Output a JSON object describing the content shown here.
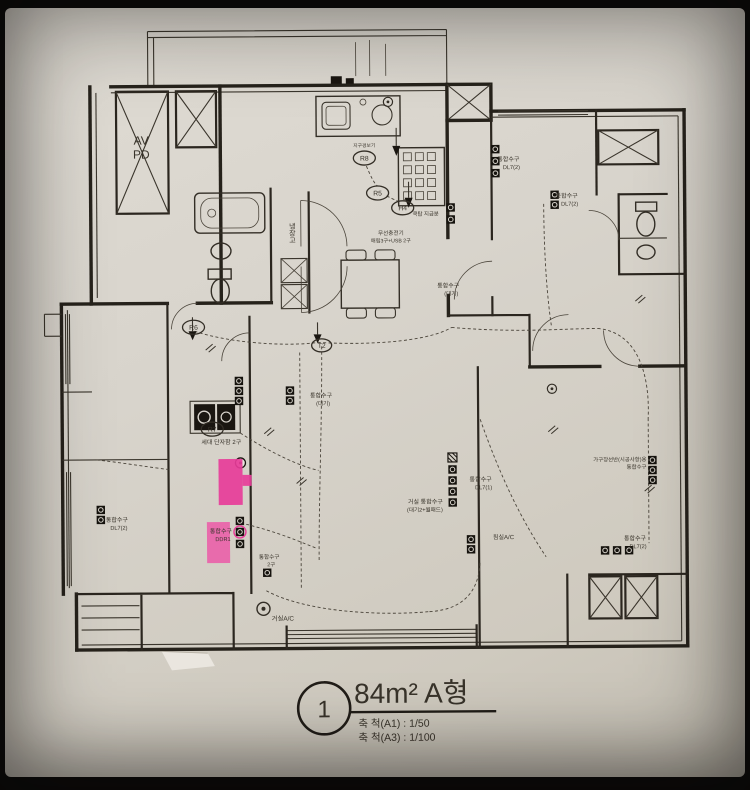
{
  "colors": {
    "paper": "#d8d4cc",
    "ink": "#26221b",
    "highlight_pink": "#e73c99",
    "highlight_pink_light": "#ea5fa9",
    "photo_frame": "#0a0a0a"
  },
  "title_block": {
    "number": "1",
    "title": "84m² A형",
    "scale_a1": "축 척(A1) : 1/50",
    "scale_a3": "축 척(A3) : 1/100"
  },
  "labels": {
    "av": "AV",
    "pd": "PD",
    "fridge": "냉장고",
    "detector": "지구경보기",
    "cooktop_note": "쿡탑 지급분",
    "wireless_1": "무선충전기",
    "wireless_2": "매립3구+USB 2구",
    "terminal_box": "세대 단자함 2구",
    "outlet": "통합수구",
    "code_daegi": "(대기)",
    "code_dl71": "DL7(1)",
    "code_dl72": "DL7(2)",
    "code_ddr1": "DDR1",
    "code_2gu": "2구",
    "living_outlet_1": "거실 통합수구",
    "living_outlet_2": "(대기2+월패드)",
    "shelf_outlet_1": "가구장선반(시공사항)용",
    "shelf_outlet_2": "통합수구",
    "living_ac": "거실A/C",
    "bedroom_ac": "침실A/C"
  },
  "refs": {
    "r5": "R5",
    "r6": "R6",
    "r7": "R7",
    "r8": "R8",
    "h4": "H4",
    "t2": "T2"
  }
}
